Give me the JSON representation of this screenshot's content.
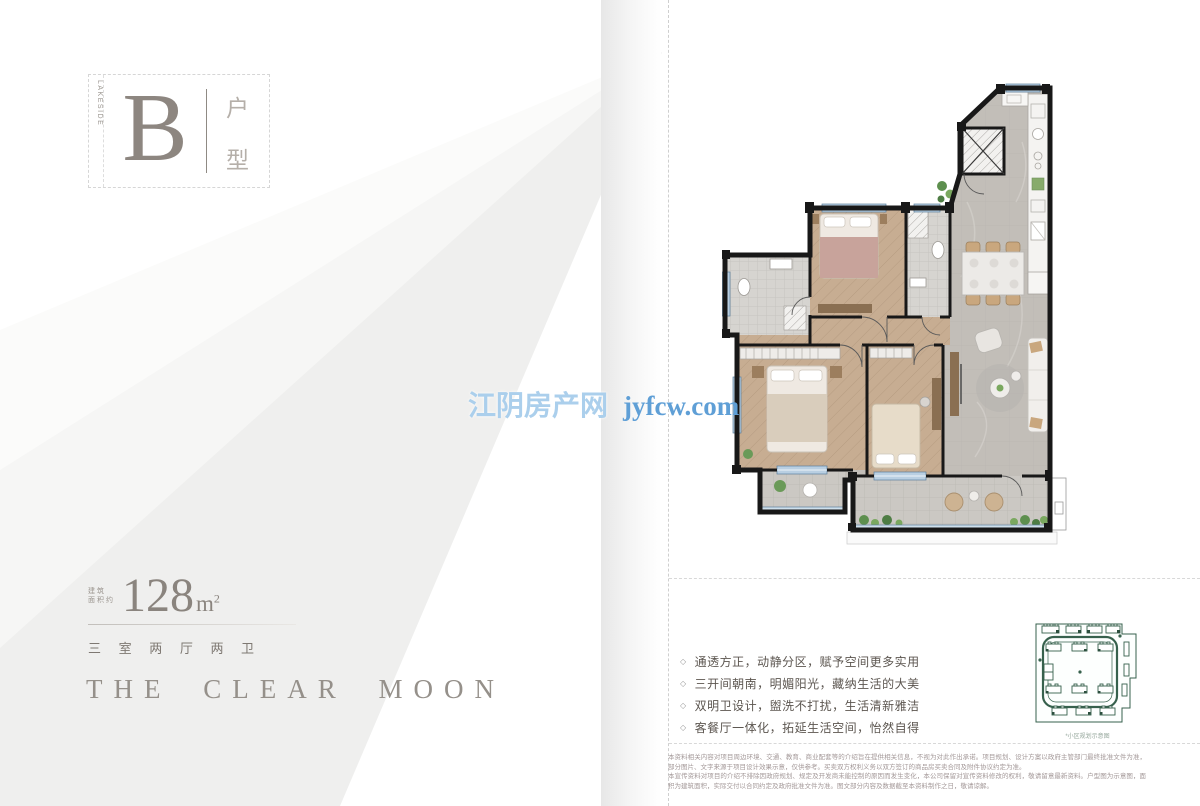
{
  "unit": {
    "letter": "B",
    "series_text": "LAKESIDE",
    "type_chars": [
      "户",
      "型"
    ]
  },
  "area": {
    "prefix_line1": "建筑",
    "prefix_line2": "面积约",
    "value": "128",
    "unit_base": "m",
    "unit_sup": "2",
    "layout": "三 室 两 厅 两 卫"
  },
  "slogan": {
    "text": "THE CLEAR MOON"
  },
  "watermark": {
    "cn": "江阴房产网",
    "en": "jyfcw.com"
  },
  "features": {
    "bullet": "◇",
    "items": [
      "通透方正，动静分区，赋予空间更多实用",
      "三开间朝南，明媚阳光，藏纳生活的大美",
      "双明卫设计，盥洗不打扰，生活清新雅洁",
      "客餐厅一体化，拓延生活空间，怡然自得"
    ]
  },
  "floor_plan": {
    "rooms": [
      "entry-kitchen",
      "elevator",
      "bedroom-north",
      "bath-north",
      "corridor",
      "master-bedroom",
      "bedroom-middle",
      "living-dining",
      "bath-west",
      "balcony-south",
      "terrace-west"
    ]
  },
  "site_map": {
    "caption": "*小区规划示意图"
  },
  "disclaimer": {
    "line1": "本资料相关内容对项目周边环境、交通、教育、商业配套等的介绍旨在提供相关信息，不视为对此作出承诺。项目规划、设计方案以政府主管部门最终批准文件为准，部分图片、文字来源于项目设计效果示意，仅供参考。买卖双方权利义务以双方签订的商品房买卖合同及附件协议约定为准。",
    "line2": "本宣传资料对项目的介绍不排除因政府规划、规定及开发商未能控制的原因而发生变化，本公司保留对宣传资料修改的权利，敬请留意最新资料。户型图为示意图，面积为建筑面积，实际交付以合同约定及政府批准文件为准。图文部分内容及数据截至本资料制作之日，敬请谅解。"
  },
  "colors": {
    "wall": "#181818",
    "wood_floor": "#c7ad92",
    "marble_floor": "#c2beb8",
    "window_blue": "#b9cfe2",
    "watermark_blue": "#5f9fd6",
    "sitemap_green": "#37614d",
    "text_gray": "#8a847e"
  }
}
